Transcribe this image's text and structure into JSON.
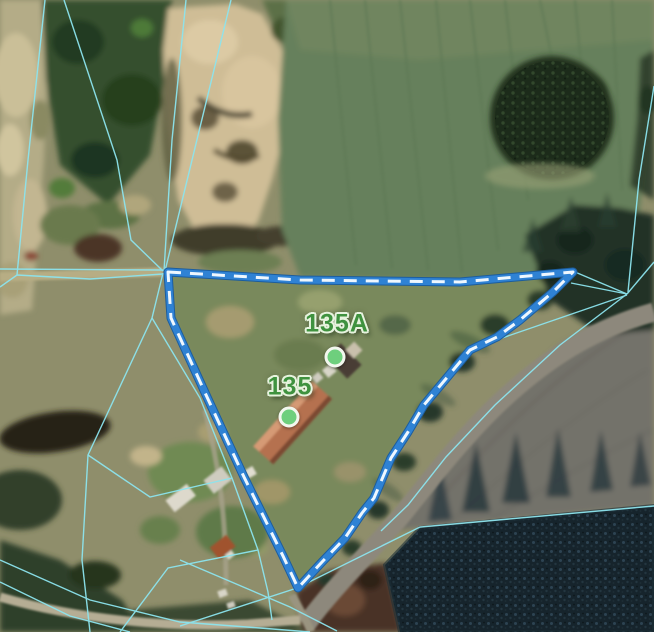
{
  "map": {
    "view_type": "satellite-cadastral",
    "markers": [
      {
        "id": "135A",
        "label": "135A"
      },
      {
        "id": "135",
        "label": "135"
      }
    ],
    "selected_parcel": {
      "boundary_color": "#2f82d4",
      "boundary_edge_color": "#1c5d9e",
      "boundary_dash_color": "#eef7ff",
      "style": "thick blue with white center dashes"
    },
    "cadastral_lines": {
      "color": "#8ce4ee",
      "style": "thin solid"
    },
    "marker_style": {
      "fill": "#6ecf7d",
      "border": "#f2f7ee"
    },
    "label_style": {
      "color": "#3f923f",
      "halo": "#e7f3de"
    }
  }
}
